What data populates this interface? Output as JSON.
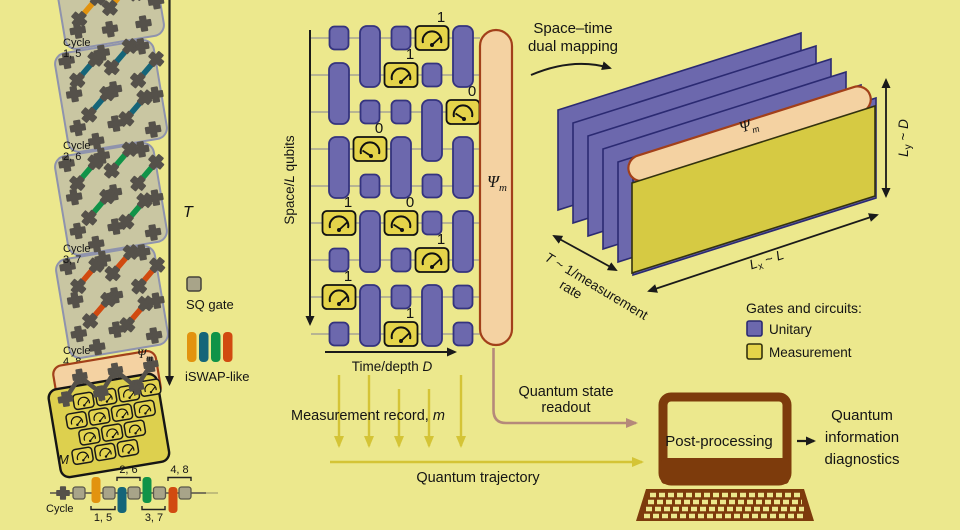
{
  "figure": {
    "colors": {
      "background": "#ece88d",
      "panel_fill": "#c9c6a2",
      "panel_border": "#8f93ad",
      "qubit_dark": "#55514a",
      "iswap_orange": "#e2930f",
      "iswap_teal": "#156579",
      "iswap_green": "#109348",
      "iswap_red": "#d14a10",
      "sq_gate_grey": "#a8a489",
      "unitary_purple": "#6c68ad",
      "unitary_border": "#34337e",
      "measure_yellow": "#e5d44a",
      "slab_yellow": "#d6ca43",
      "psi_peach": "#f4d2a2",
      "psi_border": "#a2401a",
      "laptop_brown": "#7d3b0c",
      "trajectory_yellow": "#d4c436",
      "readout_rose": "#b5897a"
    },
    "left": {
      "panels": [
        {
          "label": "Cycle",
          "num": "1, 5"
        },
        {
          "label": "Cycle",
          "num": "2, 6"
        },
        {
          "label": "Cycle",
          "num": "3, 7"
        },
        {
          "label": "Cycle",
          "num": "4, 8"
        }
      ],
      "time_label": "T",
      "psi": "Ψ",
      "psi_sub": "m",
      "m_label": "M",
      "legend_sq": "SQ gate",
      "legend_iswap": "iSWAP-like",
      "timeline_cycle": "Cycle",
      "timeline_groups": [
        "1, 5",
        "2, 6",
        "3, 7",
        "4, 8"
      ]
    },
    "circuit": {
      "space_axis_pre": "Space/",
      "space_axis_it": "L",
      "space_axis_post": " qubits",
      "time_axis_pre": "Time/depth ",
      "time_axis_it": "D",
      "outcomes": [
        "1",
        "1",
        "0",
        "0",
        "1",
        "0",
        "1",
        "1",
        "1"
      ],
      "psi": "Ψ",
      "psi_sub": "m"
    },
    "mapping_line1": "Space–time",
    "mapping_line2": "dual mapping",
    "dual": {
      "psi": "Ψ",
      "psi_sub": "m",
      "ly_it": "L",
      "ly_sub": "y",
      "ly_mid": " ~ ",
      "ly_it2": "D",
      "lx_it": "L",
      "lx_sub": "x",
      "lx_mid": " ~ ",
      "lx_it2": "L",
      "rate_it": "T",
      "rate_rest": " ~ 1/measurement",
      "rate_line2": "rate",
      "legend_title": "Gates and circuits:",
      "legend_unitary": "Unitary",
      "legend_measurement": "Measurement"
    },
    "flow": {
      "record_pre": "Measurement record, ",
      "record_it": "m",
      "readout_line1": "Quantum state",
      "readout_line2": "readout",
      "trajectory": "Quantum trajectory",
      "post": "Post-processing",
      "diag1": "Quantum",
      "diag2": "information",
      "diag3": "diagnostics"
    }
  }
}
